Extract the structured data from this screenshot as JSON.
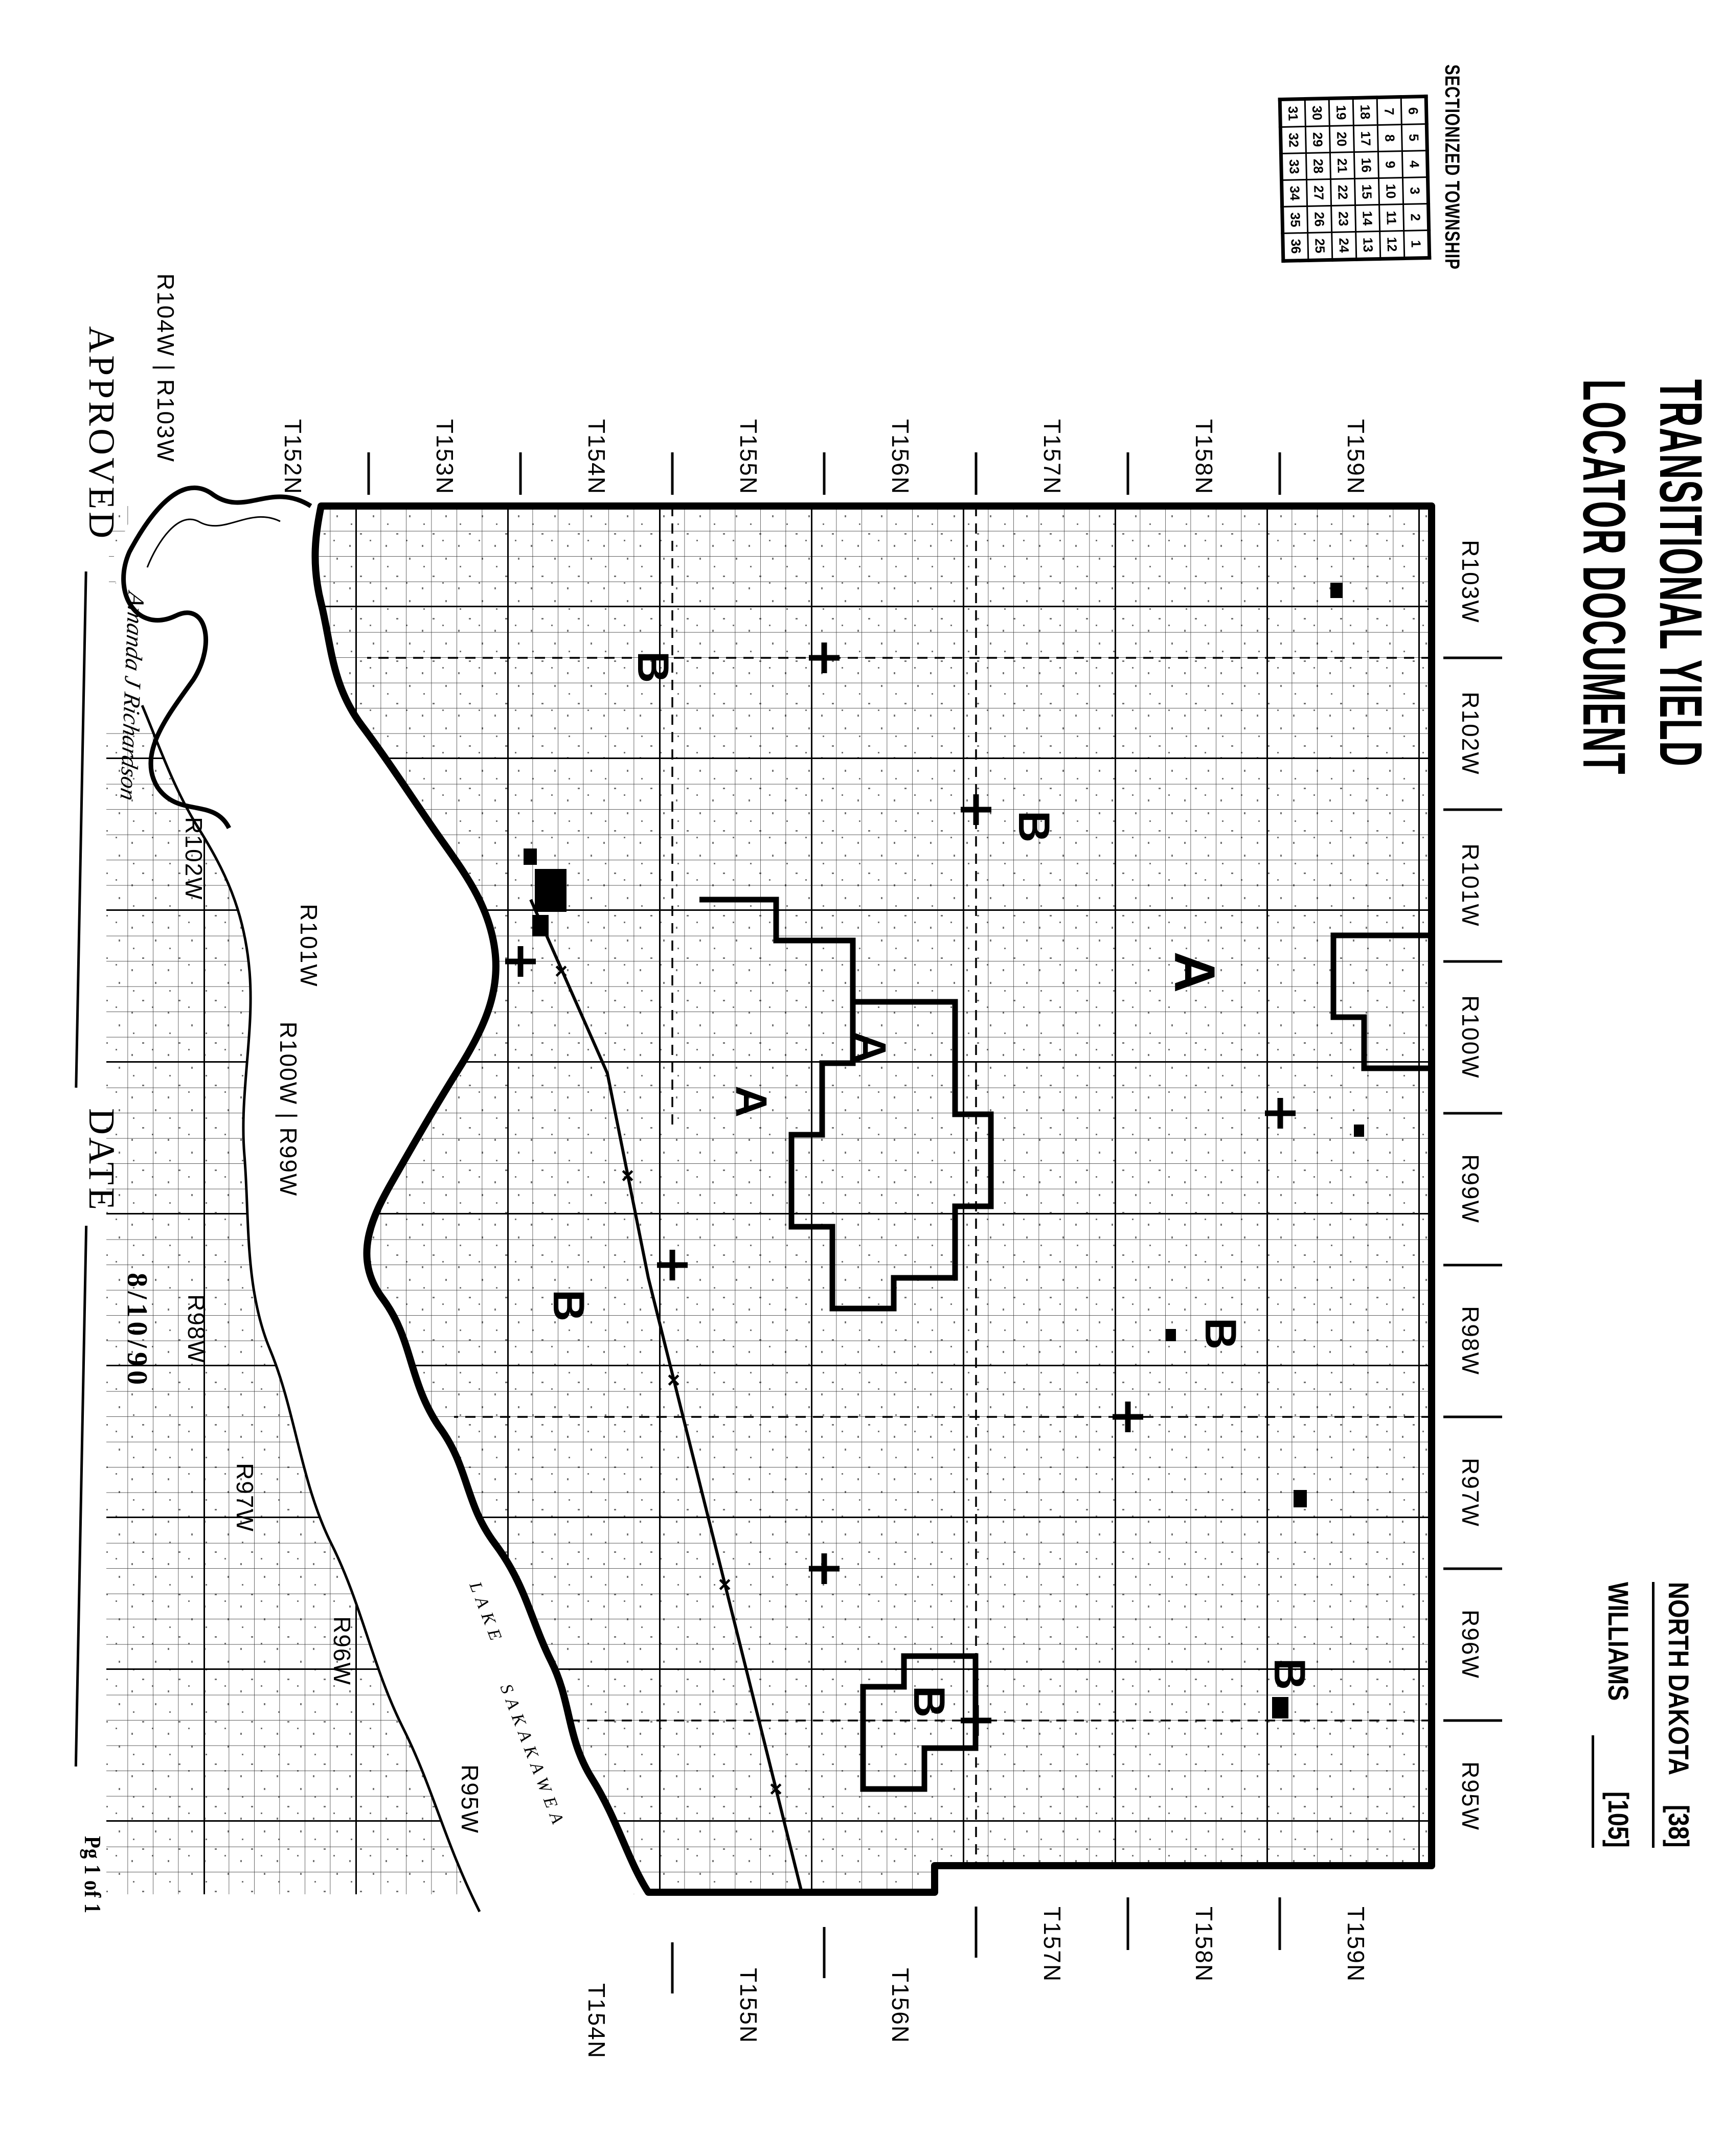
{
  "header": {
    "sectionized_label": "SECTIONIZED TOWNSHIP",
    "township_table": {
      "rows": [
        [
          6,
          5,
          4,
          3,
          2,
          1
        ],
        [
          7,
          8,
          9,
          10,
          11,
          12
        ],
        [
          18,
          17,
          16,
          15,
          14,
          13
        ],
        [
          19,
          20,
          21,
          22,
          23,
          24
        ],
        [
          30,
          29,
          28,
          27,
          26,
          25
        ],
        [
          31,
          32,
          33,
          34,
          35,
          36
        ]
      ]
    },
    "title_line1": "TRANSITIONAL YIELD",
    "title_line2": "LOCATOR DOCUMENT",
    "state": {
      "name": "NORTH DAKOTA",
      "code": "[38]"
    },
    "county": {
      "name": "WILLIAMS",
      "code": "[105]"
    }
  },
  "map": {
    "west_labels": [
      "T159N",
      "T158N",
      "T157N",
      "T156N",
      "T155N",
      "T154N",
      "T153N",
      "T152N"
    ],
    "north_labels": [
      "R103W",
      "R102W",
      "R101W",
      "R100W",
      "R99W",
      "R98W",
      "R97W",
      "R96W",
      "R95W"
    ],
    "east_labels": [
      "T159N",
      "T158N",
      "T157N",
      "T156N",
      "T155N",
      "T154N"
    ],
    "south_labels": [
      "R104W | R103W",
      "R102W",
      "R101W",
      "R100W | R99W",
      "R98W",
      "R97W",
      "R96W",
      "R95W"
    ],
    "region_letters": [
      {
        "letter": "B"
      },
      {
        "letter": "B"
      },
      {
        "letter": "B"
      },
      {
        "letter": "B"
      },
      {
        "letter": "B"
      },
      {
        "letter": "B"
      },
      {
        "letter": "A"
      },
      {
        "letter": "A"
      },
      {
        "letter": "A"
      }
    ],
    "lake_word1": "LAKE",
    "lake_word2": "SAKAKAWEA"
  },
  "footer": {
    "approved_label": "APPROVED",
    "signature": "Amanda J Richardson",
    "date_label": "DATE",
    "date_value": "8/10/90",
    "page_label": "Pg 1 of 1"
  }
}
